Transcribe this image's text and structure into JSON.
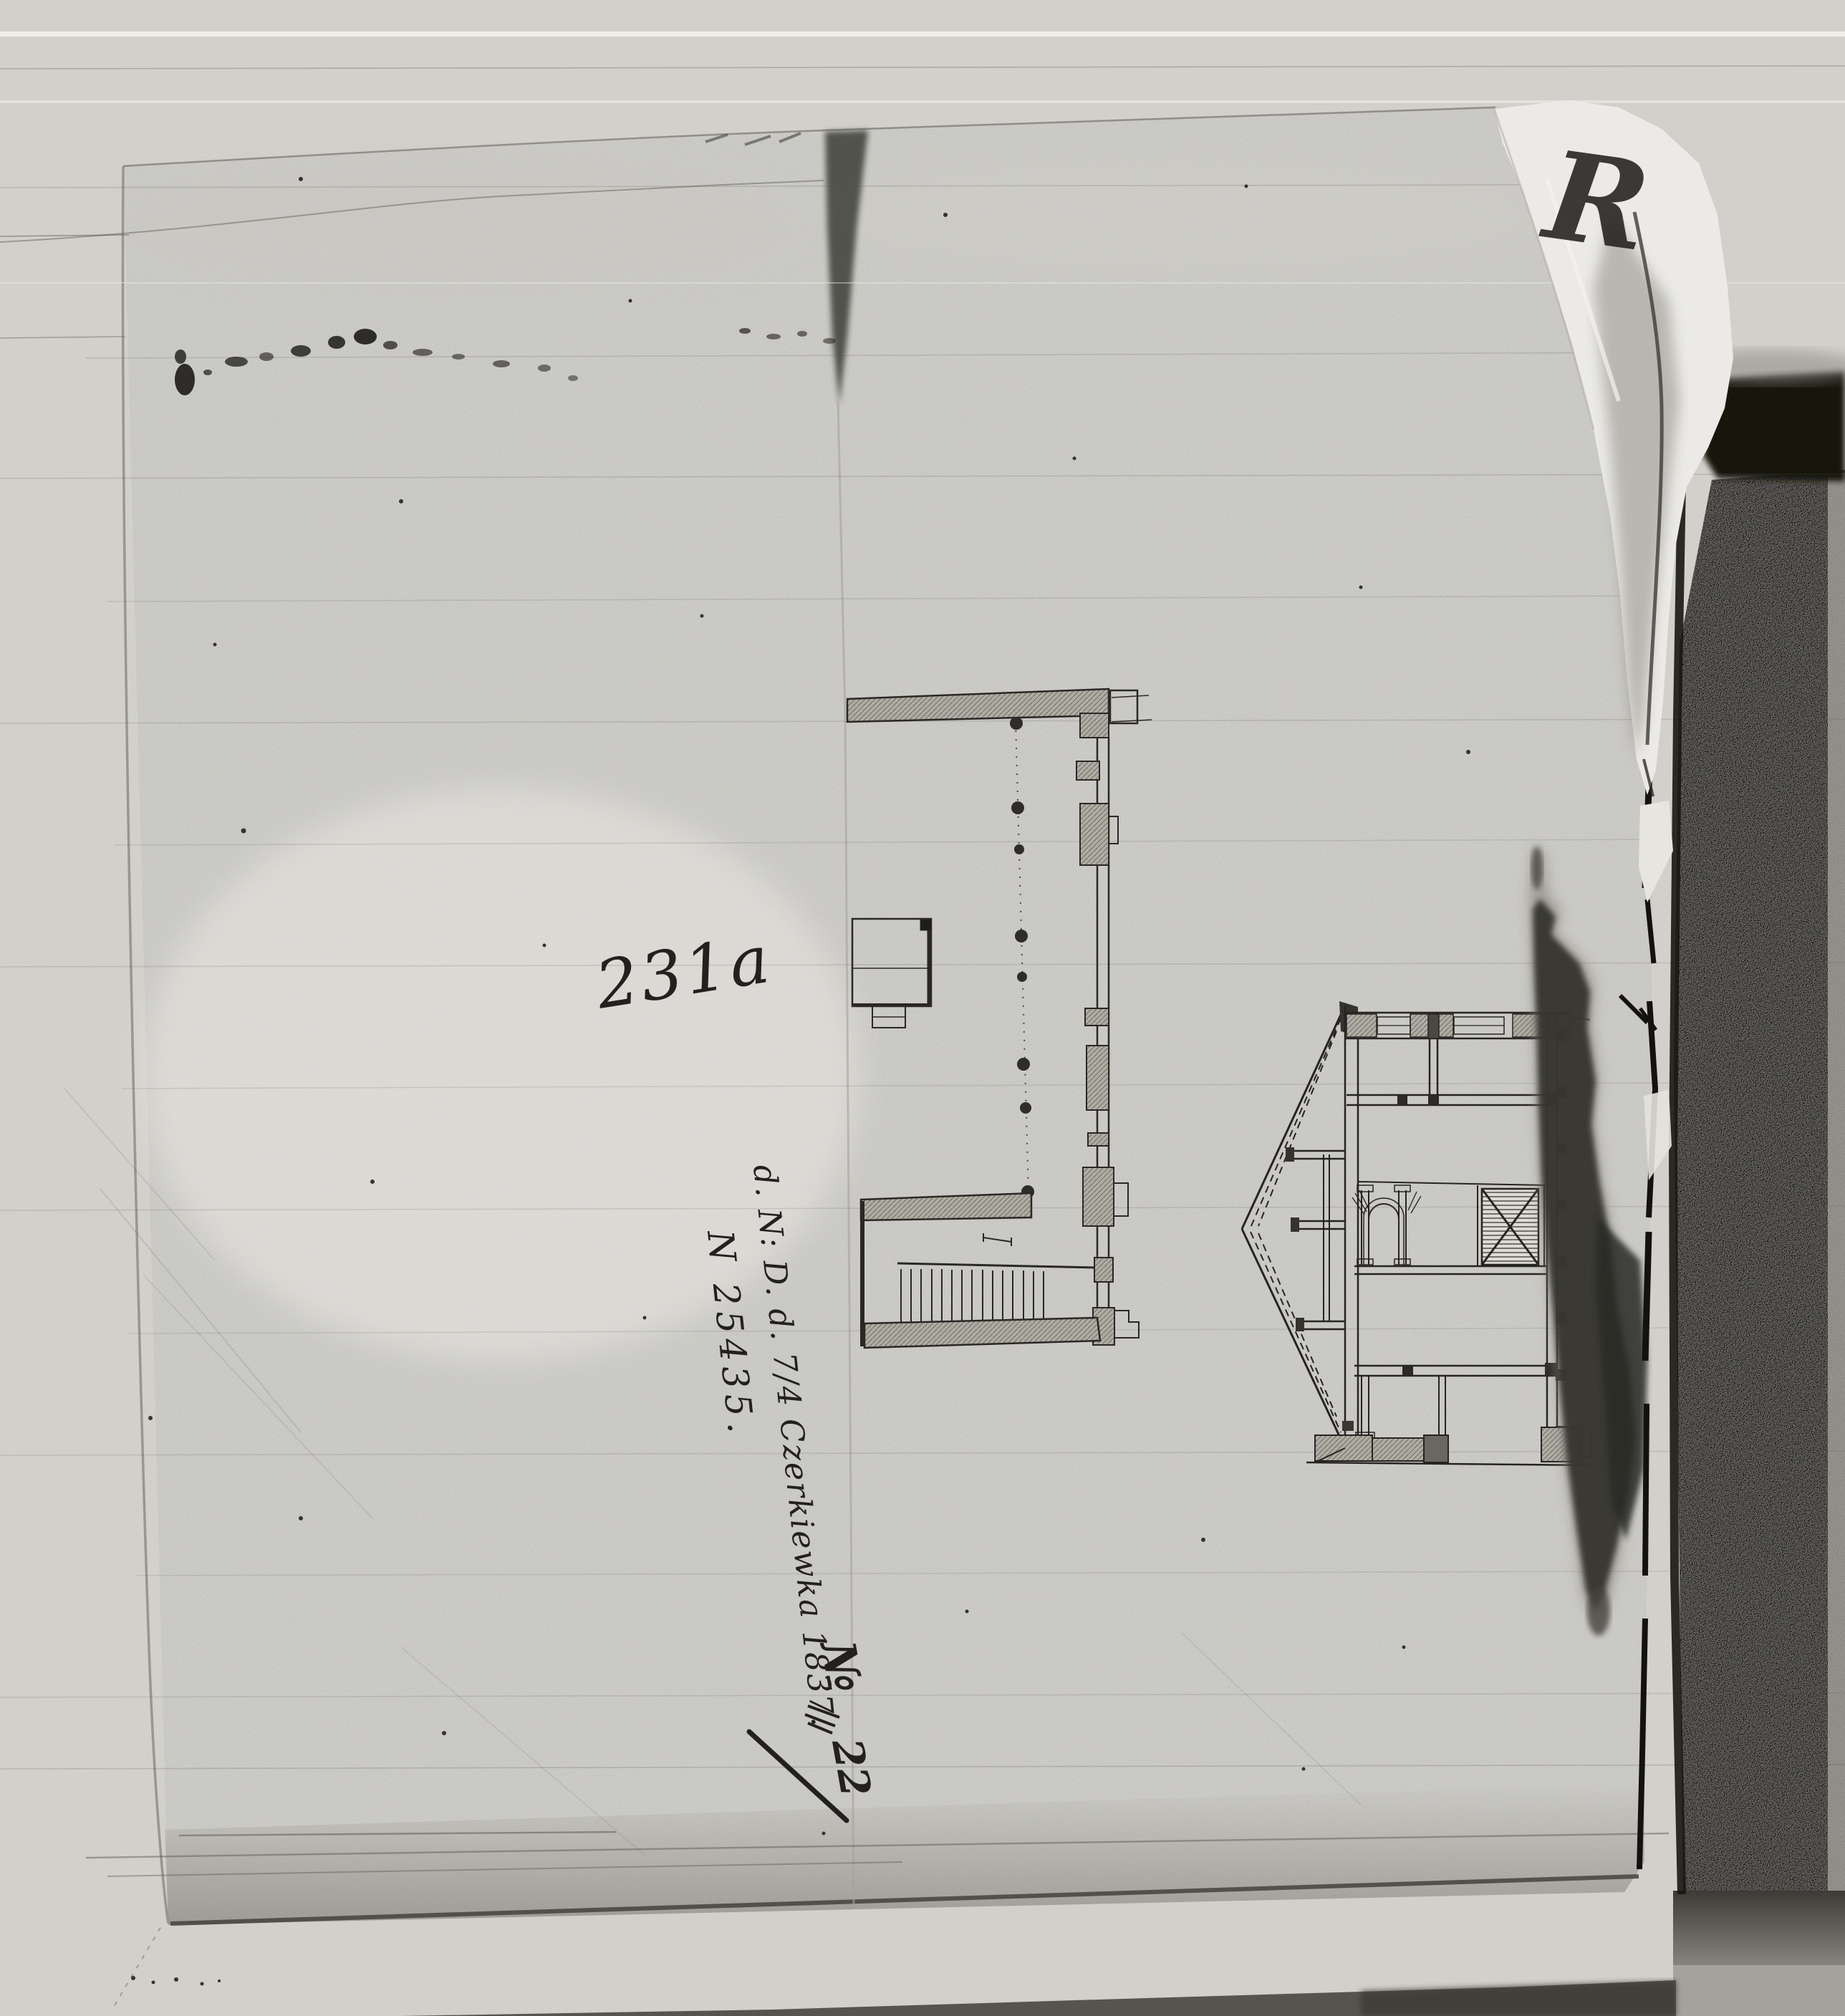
{
  "annotations": {
    "sheet_number": "231a",
    "archival_note": "d. N: D. d. 7/4 Czerkiewka 1837.",
    "inventory_note": "N 25435.",
    "folio_symbol": "№",
    "folio_number": "22",
    "corner_mark": "R"
  },
  "colors": {
    "background": "#d2d0cb",
    "paper": "#e4e3de",
    "cover_page": "#b6b3ac",
    "ink": "#23211d",
    "stain_dark": "#33312c",
    "gap_black": "#14120f"
  }
}
